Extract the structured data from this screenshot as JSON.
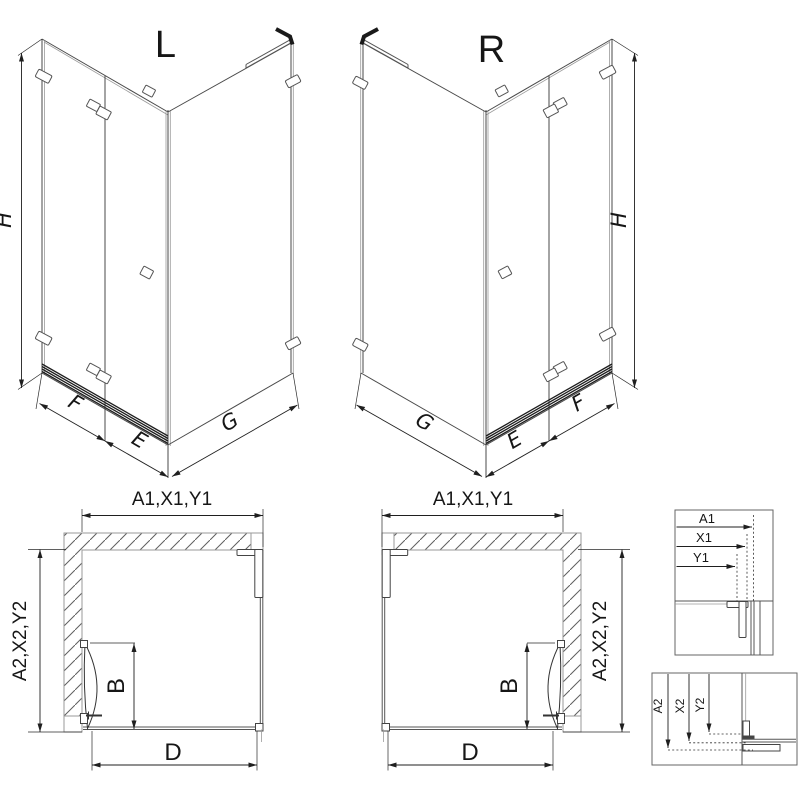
{
  "iso_left": {
    "label": "L",
    "height": "H",
    "front_door": "F",
    "front_fixed": "E",
    "side": "G"
  },
  "iso_right": {
    "label": "R",
    "height": "H",
    "front_door": "F",
    "front_fixed": "E",
    "side": "G"
  },
  "plan_left": {
    "width": "A1,X1,Y1",
    "depth": "A2,X2,Y2",
    "door_width": "B",
    "front_width": "D"
  },
  "plan_right": {
    "width": "A1,X1,Y1",
    "depth": "A2,X2,Y2",
    "door_width": "B",
    "front_width": "D"
  },
  "detail_width": {
    "rows": [
      "A1",
      "X1",
      "Y1"
    ]
  },
  "detail_depth": {
    "rows": [
      "A2",
      "X2",
      "Y2"
    ]
  },
  "colors": {
    "line": "#3a3a3a",
    "dim": "#1f1f1f",
    "secondary": "#9a9a9a",
    "hatch": "#5f5f5f",
    "dark": "#1a1a1a",
    "background": "#ffffff"
  }
}
